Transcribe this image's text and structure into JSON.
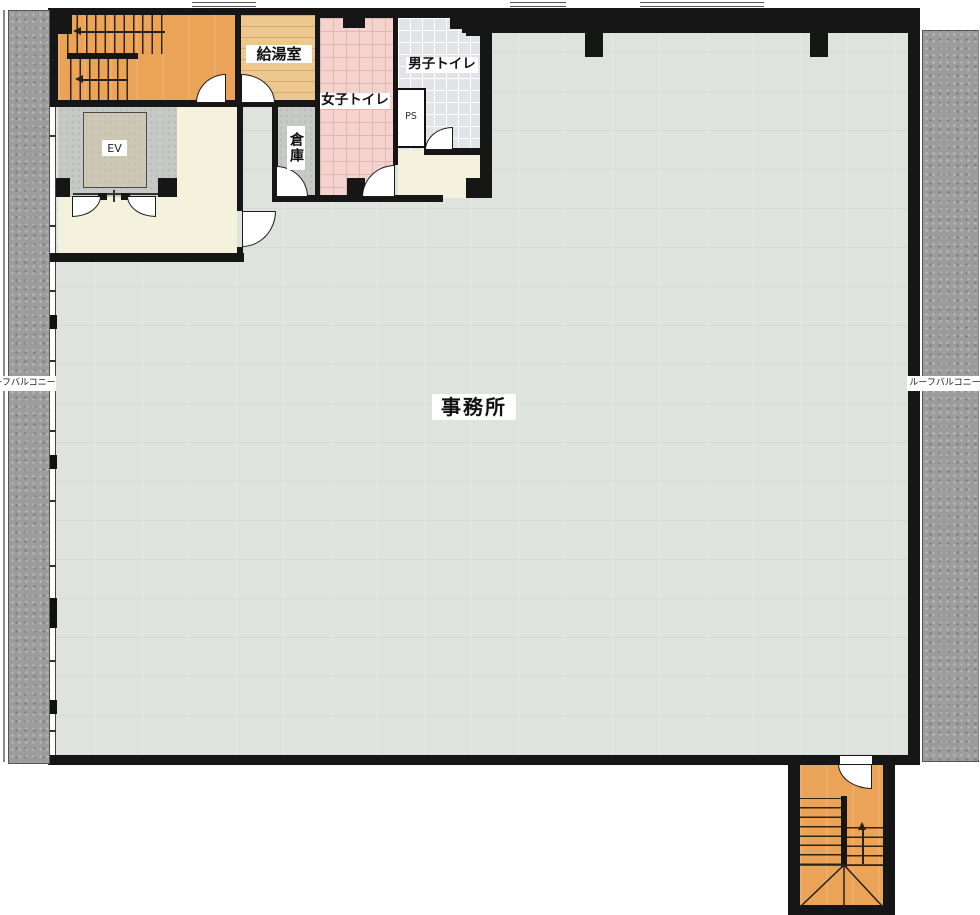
{
  "rooms": {
    "office": "事務所",
    "kitchenette": "給湯室",
    "womens_toilet": "女子トイレ",
    "mens_toilet": "男子トイレ",
    "storage": "倉庫",
    "pipe_space": "PS",
    "elevator": "EV",
    "roof_balcony_left": "ルーフバルコニー",
    "roof_balcony_right": "ルーフバルコニー"
  },
  "colors": {
    "office_floor": "#dfe3de",
    "stair": "#eba457",
    "kitchenette_wood": "#edc88e",
    "womens_tile_pink": "#f4d2ce",
    "mens_tile_gray": "#e2e3e8",
    "hall_cream": "#f4f2dc",
    "lobby_gray": "#c7c9c6",
    "balcony_gray": "#9c9c9c",
    "wall_black": "#161616"
  }
}
